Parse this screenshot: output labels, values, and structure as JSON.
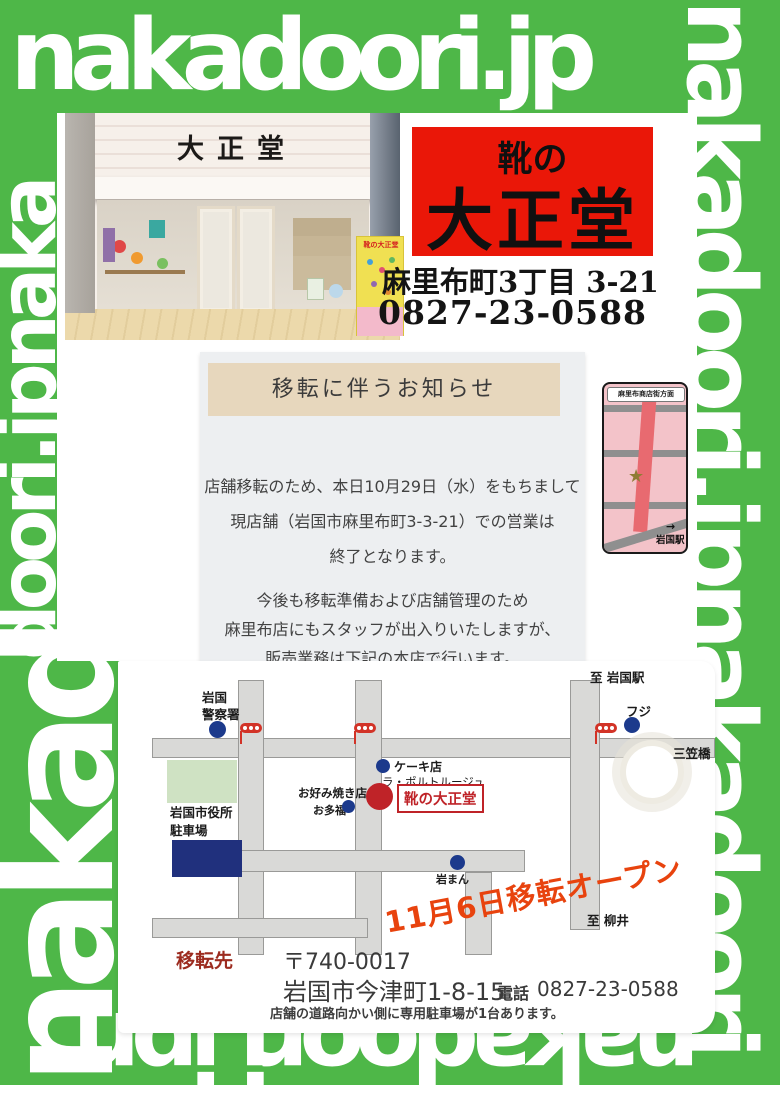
{
  "brand": {
    "top": "nakadoori.jp",
    "right_column": "nakadoori.jpnakadoori",
    "left_column_upper": "doori.jpnaka",
    "left_column_lower": "nakad",
    "bottom_row": "nakadoori.jpn"
  },
  "colors": {
    "frame_green": "#4eb748",
    "sign_red": "#ea1708",
    "map_red": "#bf2328",
    "open_banner_red": "#e8430e",
    "relocation_label_maroon": "#9c2b1f",
    "map_dot_navy": "#1c3a8c"
  },
  "photo": {
    "facade_sign": "大正堂",
    "standing_sign_text": "靴の大正堂"
  },
  "store_sign": {
    "prefix": "靴の",
    "name": "大正堂",
    "address": "麻里布町3丁目 3-21",
    "phone": "0827-23-0588"
  },
  "notice": {
    "title": "移転に伴うお知らせ",
    "para1": [
      "店舗移転のため、本日10月29日（水）をもちまして",
      "現店舗（岩国市麻里布町3-3-21）での営業は",
      "終了となります。"
    ],
    "para2": [
      "今後も移転準備および店舗管理のため",
      "麻里布店にもスタッフが出入りいたしますが、",
      "販売業務は下記の本店で行います。"
    ]
  },
  "mini_map": {
    "heading": "麻里布商店街方面",
    "station": "岩国駅",
    "arrow": "→",
    "star": "★"
  },
  "map": {
    "police_line1": "岩国",
    "police_line2": "警察署",
    "cityhall_line1": "岩国市役所",
    "cityhall_line2": "駐車場",
    "cake_shop": "ケーキ店",
    "la_porte_rouge": "ラ・ポルトルージュ",
    "shoe_store": "靴の大正堂",
    "okonomiyaki": "お好み焼き店",
    "otafuku": "お多福",
    "fuji": "フジ",
    "mikasa_bridge": "三笠橋",
    "to_iwakuni_station": "至 岩国駅",
    "iwaman": "岩まん",
    "to_yanai": "至 柳井",
    "open_banner": "11月6日移転オープン"
  },
  "relocation": {
    "label": "移転先",
    "postal_code": "〒740-0017",
    "address": "岩国市今津町1-8-15",
    "phone_label": "電話",
    "phone": "0827-23-0588",
    "note": "店舗の道路向かい側に専用駐車場が1台あります。"
  }
}
